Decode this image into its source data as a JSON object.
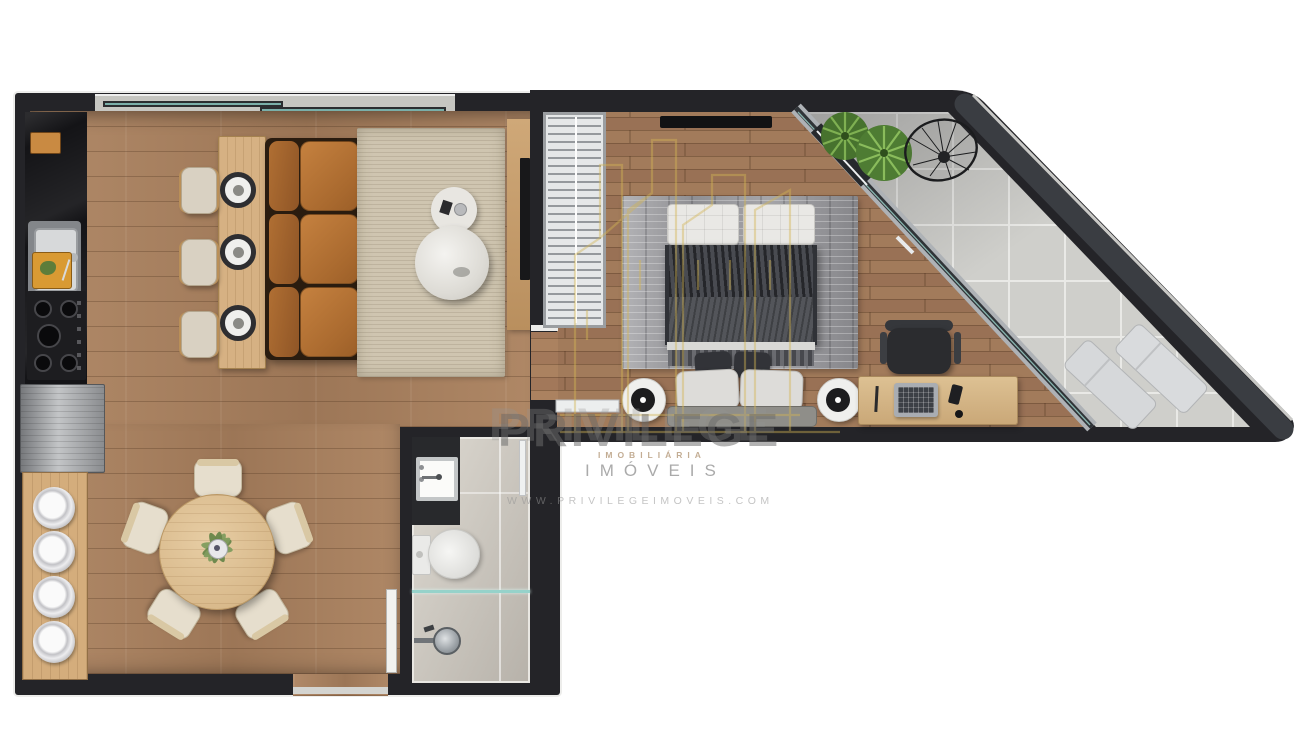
{
  "watermark": {
    "brand": "PRIVILEGE",
    "tagline_small": "IMOBILIÁRIA",
    "brand_sub": "IMÓVEIS",
    "website": "WWW.PRIVILEGEIMOVEIS.COM"
  },
  "palette": {
    "wall": "#242428",
    "outer_diagonal_wall": "#3a3d42",
    "wood_floor": "#a87f5d",
    "light_wood_furniture": "#d6b183",
    "balcony_tile": "#cfcfcb",
    "sofa_leather": "#b5713a",
    "rug_living": "#cfc5b0",
    "rug_bedroom": "#9a9a9e",
    "glass_teal": "#96d2ca",
    "logo_gold": "#d4b654",
    "watermark_gray": "#8a8a8a",
    "plant_green": "#5e8f3e"
  },
  "icons": {
    "sink": "kitchen-sink",
    "stove": "cooktop-4-burners",
    "sofa": "three-seat-leather-sofa",
    "bed": "double-bed",
    "toilet": "toilet",
    "shower": "shower-head",
    "dining_table": "round-dining-table-5-chairs",
    "loungers": "two-sun-loungers",
    "string_chair": "acapulco-chair",
    "plants": "balcony-plants",
    "desk": "home-office-desk-laptop"
  }
}
